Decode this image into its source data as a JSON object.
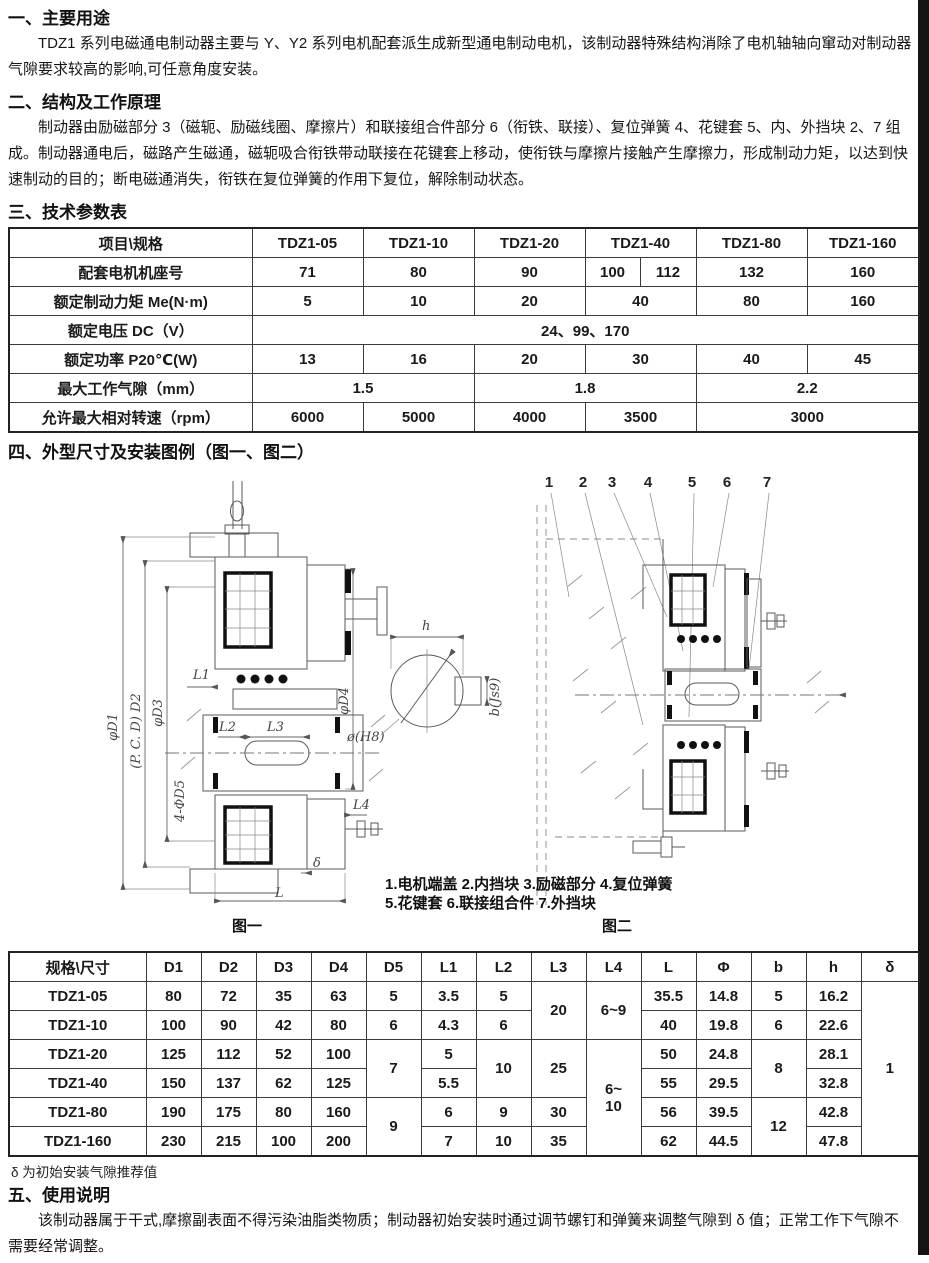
{
  "edge_color": "#141414",
  "sections": {
    "usage": {
      "heading": "一、主要用途",
      "body": "TDZ1 系列电磁通电制动器主要与 Y、Y2 系列电机配套派生成新型通电制动电机，该制动器特殊结构消除了电机轴轴向窜动对制动器气隙要求较高的影响,可任意角度安装。"
    },
    "structure": {
      "heading": "二、结构及工作原理",
      "body": "制动器由励磁部分 3（磁轭、励磁线圈、摩擦片）和联接组合件部分 6（衔铁、联接）、复位弹簧 4、花键套 5、内、外挡块 2、7 组成。制动器通电后，磁路产生磁通，磁轭吸合衔铁带动联接在花键套上移动，使衔铁与摩擦片接触产生摩擦力，形成制动力矩，以达到快速制动的目的；断电磁通消失，衔铁在复位弹簧的作用下复位，解除制动状态。"
    },
    "params": {
      "heading": "三、技术参数表"
    },
    "dimensions": {
      "heading": "四、外型尺寸及安装图例（图一、图二）"
    },
    "instructions": {
      "heading": "五、使用说明",
      "body": "该制动器属于干式,摩擦副表面不得污染油脂类物质；制动器初始安装时通过调节螺钉和弹簧来调整气隙到 δ 值；正常工作下气隙不需要经常调整。"
    }
  },
  "params_table": {
    "col_widths": [
      243,
      111,
      111,
      111,
      55,
      56,
      111,
      112
    ],
    "rows": [
      [
        {
          "t": "项目\\规格"
        },
        {
          "t": "TDZ1-05"
        },
        {
          "t": "TDZ1-10"
        },
        {
          "t": "TDZ1-20"
        },
        {
          "t": "TDZ1-40",
          "cs": 2
        },
        {
          "t": "TDZ1-80"
        },
        {
          "t": "TDZ1-160"
        }
      ],
      [
        "配套电机机座号",
        "71",
        "80",
        "90",
        "100",
        "112",
        "132",
        "160"
      ],
      [
        "额定制动力矩 Me(N·m)",
        "5",
        "10",
        "20",
        {
          "t": "40",
          "cs": 2
        },
        "80",
        "160"
      ],
      [
        "额定电压 DC（V）",
        {
          "t": "24、99、170",
          "cs": 7
        }
      ],
      [
        "额定功率 P20℃(W)",
        "13",
        "16",
        "20",
        {
          "t": "30",
          "cs": 2
        },
        "40",
        "45"
      ],
      [
        "最大工作气隙（mm）",
        {
          "t": "1.5",
          "cs": 2
        },
        {
          "t": "1.8",
          "cs": 3
        },
        {
          "t": "2.2",
          "cs": 2
        }
      ],
      [
        "允许最大相对转速（rpm）",
        "6000",
        "5000",
        "4000",
        {
          "t": "3500",
          "cs": 2
        },
        {
          "t": "3000",
          "cs": 2
        }
      ]
    ]
  },
  "dims_table": {
    "col_widths": [
      137,
      55,
      55,
      55,
      55,
      55,
      55,
      55,
      55,
      55,
      55,
      55,
      55,
      55,
      58
    ],
    "rows": [
      [
        "规格\\尺寸",
        "D1",
        "D2",
        "D3",
        "D4",
        "D5",
        "L1",
        "L2",
        "L3",
        "L4",
        "L",
        "Φ",
        "b",
        "h",
        "δ"
      ],
      [
        "TDZ1-05",
        "80",
        "72",
        "35",
        "63",
        "5",
        "3.5",
        "5",
        {
          "t": "20",
          "rs": 2
        },
        {
          "t": "6~9",
          "rs": 2
        },
        "35.5",
        "14.8",
        "5",
        "16.2",
        {
          "t": "1",
          "rs": 6
        }
      ],
      [
        "TDZ1-10",
        "100",
        "90",
        "42",
        "80",
        "6",
        "4.3",
        "6",
        "40",
        "19.8",
        "6",
        "22.6"
      ],
      [
        "TDZ1-20",
        "125",
        "112",
        "52",
        "100",
        {
          "t": "7",
          "rs": 2
        },
        "5",
        {
          "t": "10",
          "rs": 2
        },
        {
          "t": "25",
          "rs": 2
        },
        {
          "t": "6~\n10",
          "rs": 4
        },
        "50",
        "24.8",
        {
          "t": "8",
          "rs": 2
        },
        "28.1"
      ],
      [
        "TDZ1-40",
        "150",
        "137",
        "62",
        "125",
        "5.5",
        "55",
        "29.5",
        "32.8"
      ],
      [
        "TDZ1-80",
        "190",
        "175",
        "80",
        "160",
        {
          "t": "9",
          "rs": 2
        },
        "6",
        "9",
        "30",
        "56",
        "39.5",
        {
          "t": "12",
          "rs": 2
        },
        "42.8"
      ],
      [
        "TDZ1-160",
        "230",
        "215",
        "100",
        "200",
        "7",
        "10",
        "35",
        "62",
        "44.5",
        "47.8"
      ]
    ],
    "footnote": "δ 为初始安装气隙推荐值"
  },
  "figures": {
    "fig1_caption": "图一",
    "fig2_caption": "图二",
    "legend_line1": "1.电机端盖 2.内挡块 3.励磁部分 4.复位弹簧",
    "legend_line2": "5.花键套 6.联接组合件 7.外挡块",
    "callouts": [
      "1",
      "2",
      "3",
      "4",
      "5",
      "6",
      "7"
    ],
    "dim_labels": {
      "d1": "φD1",
      "d2": "(P. C. D) D2",
      "d3": "φD3",
      "d4": "φD4",
      "d5": "4-ΦD5",
      "l1": "L1",
      "l2": "L2",
      "l3": "L3",
      "l4": "L4",
      "l": "L",
      "delta": "δ",
      "h": "h",
      "oh8": "ø(H8)",
      "bjs9": "b(Js9)"
    }
  }
}
